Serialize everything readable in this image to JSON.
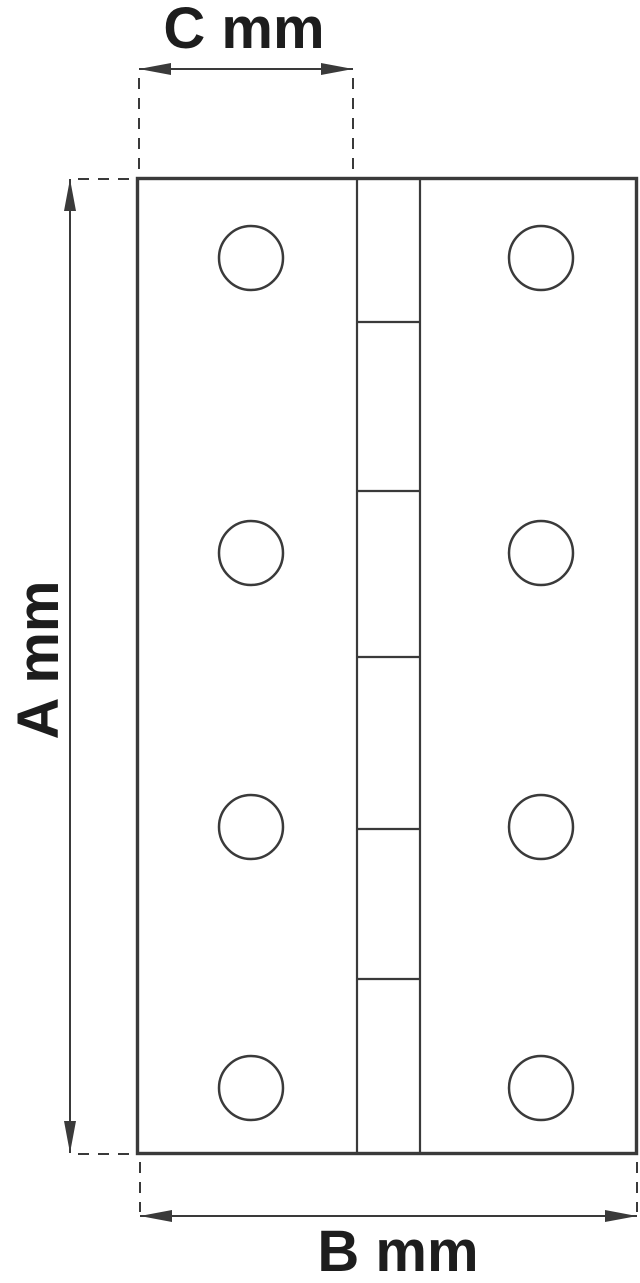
{
  "diagram": {
    "subject": "butt hinge technical drawing, front view",
    "dimensions": {
      "height_label": "A mm",
      "width_label": "B mm",
      "leaf_label": "C mm"
    },
    "colors": {
      "line": "#3a3a3a",
      "text": "#1d1d1d",
      "background": "#ffffff"
    },
    "counts": {
      "screw_holes": 8,
      "knuckle_segments": 6
    }
  }
}
